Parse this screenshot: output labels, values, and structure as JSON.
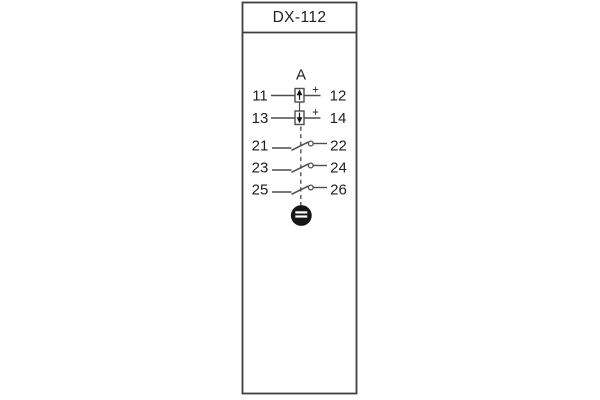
{
  "device": {
    "model": "DX-112",
    "group_label": "A",
    "polarity_mark": "+",
    "terminal_rows": [
      {
        "left": "11",
        "right": "12",
        "symbol": "polarized-element-arrow-up"
      },
      {
        "left": "13",
        "right": "14",
        "symbol": "polarized-element-arrow-down"
      },
      {
        "left": "21",
        "right": "22",
        "symbol": "normally-open-contact"
      },
      {
        "left": "23",
        "right": "24",
        "symbol": "normally-open-contact"
      },
      {
        "left": "25",
        "right": "26",
        "symbol": "normally-open-contact"
      }
    ],
    "bottom_symbol": "ground-terminal",
    "colors": {
      "line": "#4d4d4d",
      "outline": "#3f3f3f",
      "text": "#1f1f1f",
      "symbol_fill": "#161616",
      "background": "#ffffff"
    }
  }
}
